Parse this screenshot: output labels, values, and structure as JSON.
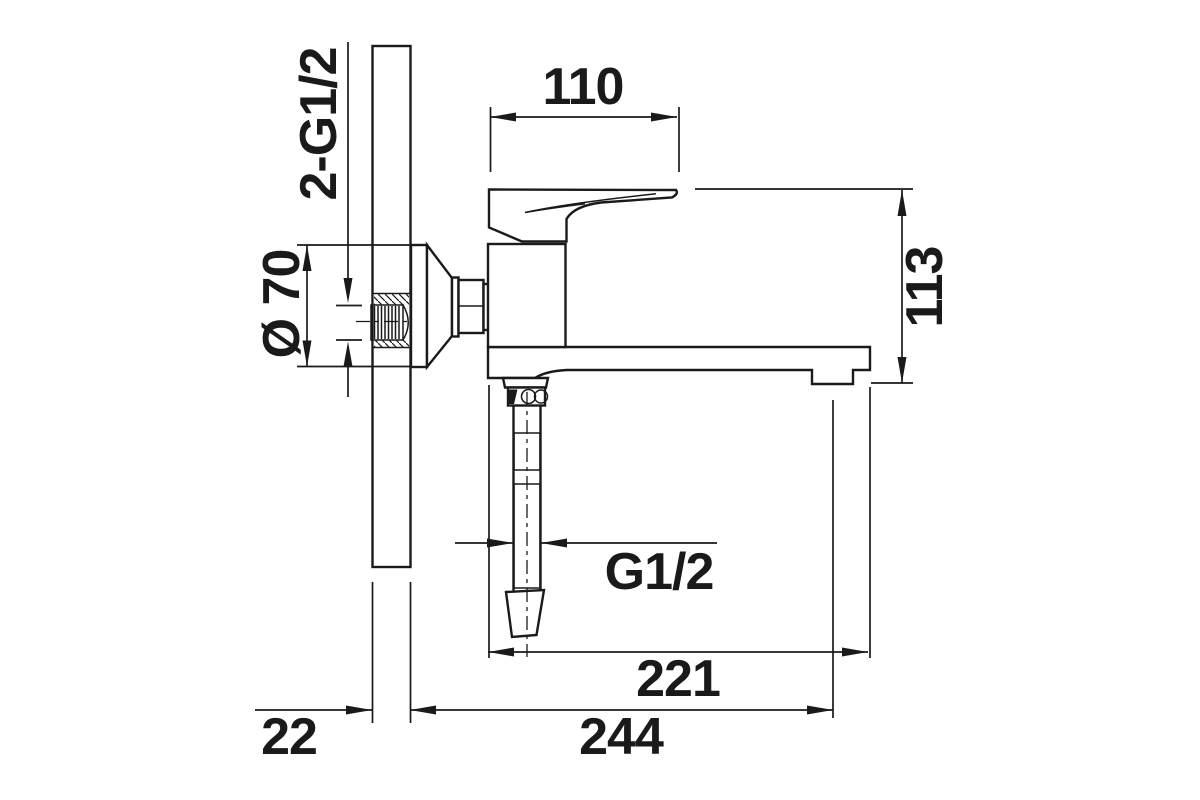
{
  "drawing": {
    "background_color": "#ffffff",
    "line_color": "#1a1a1a",
    "dimensions": {
      "handle_width": "110",
      "wall_connection_thread": "2-G1/2",
      "escutcheon_diameter": "Ø 70",
      "overall_height": "113",
      "hose_thread": "G1/2",
      "spout_reach": "221",
      "overall_depth": "244",
      "wall_thickness": "22"
    }
  }
}
